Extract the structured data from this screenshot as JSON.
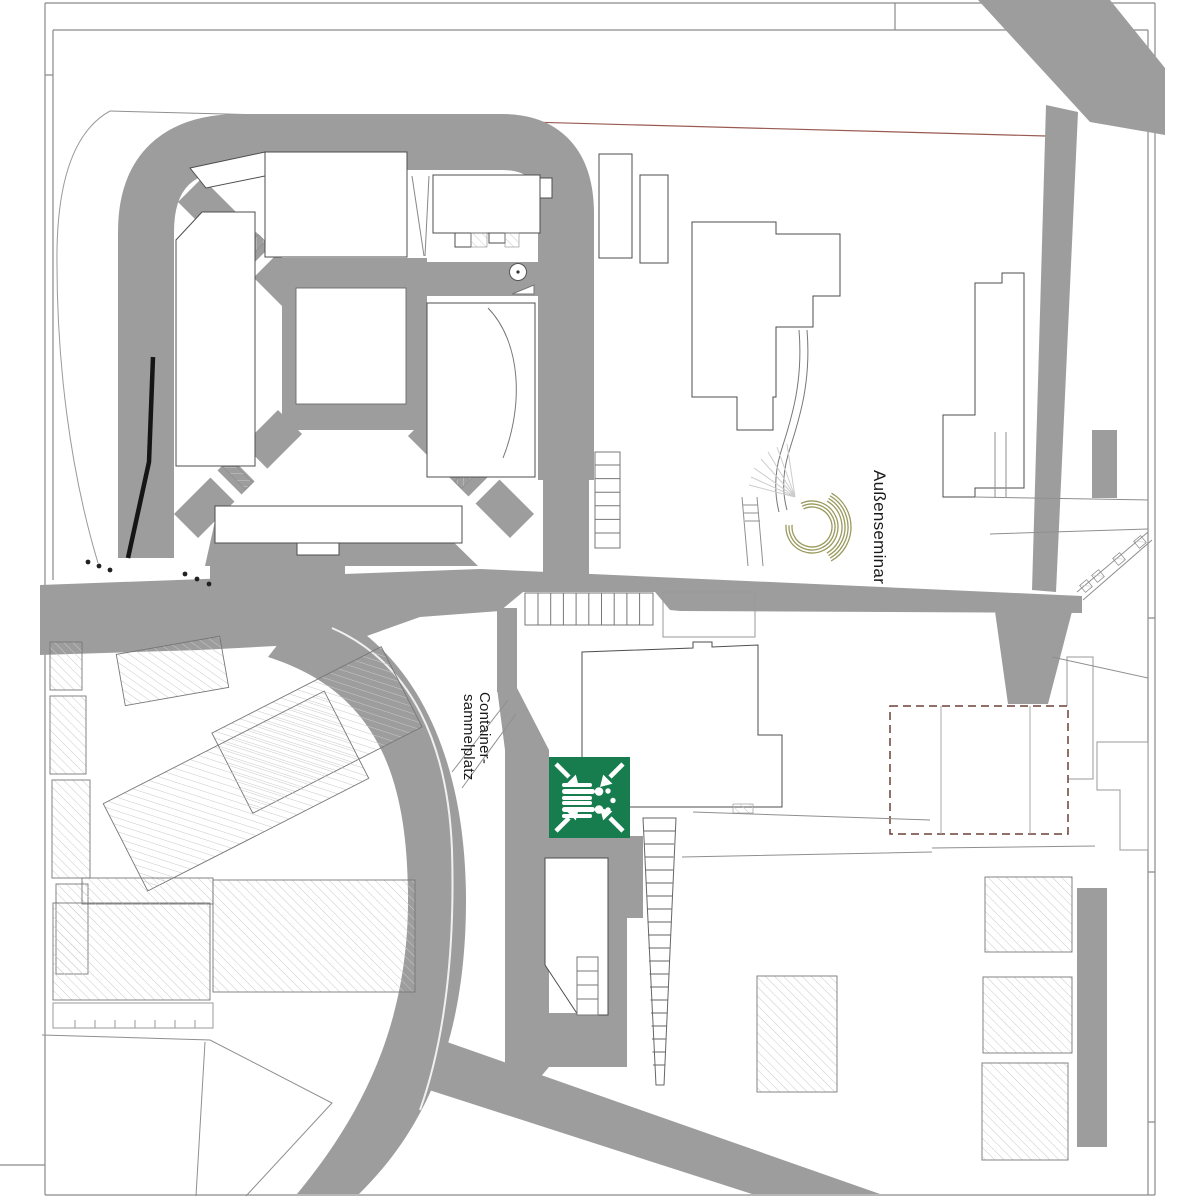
{
  "map": {
    "labels": {
      "aussenseminar": "Außenseminar",
      "container_line1": "Container-",
      "container_line2": "sammelplatz"
    },
    "colors": {
      "road": "#9d9d9d",
      "assembly_green": "#177d4e",
      "olive": "#9a9a5e",
      "boundary_red": "#9a5a52",
      "planned_outline": "#6d4038",
      "frame": "#8a8a8a",
      "hatch": "#c9c9c9",
      "building_outline": "#4d4d4d"
    },
    "icons": {
      "assembly_point": "assembly-point-icon"
    }
  }
}
